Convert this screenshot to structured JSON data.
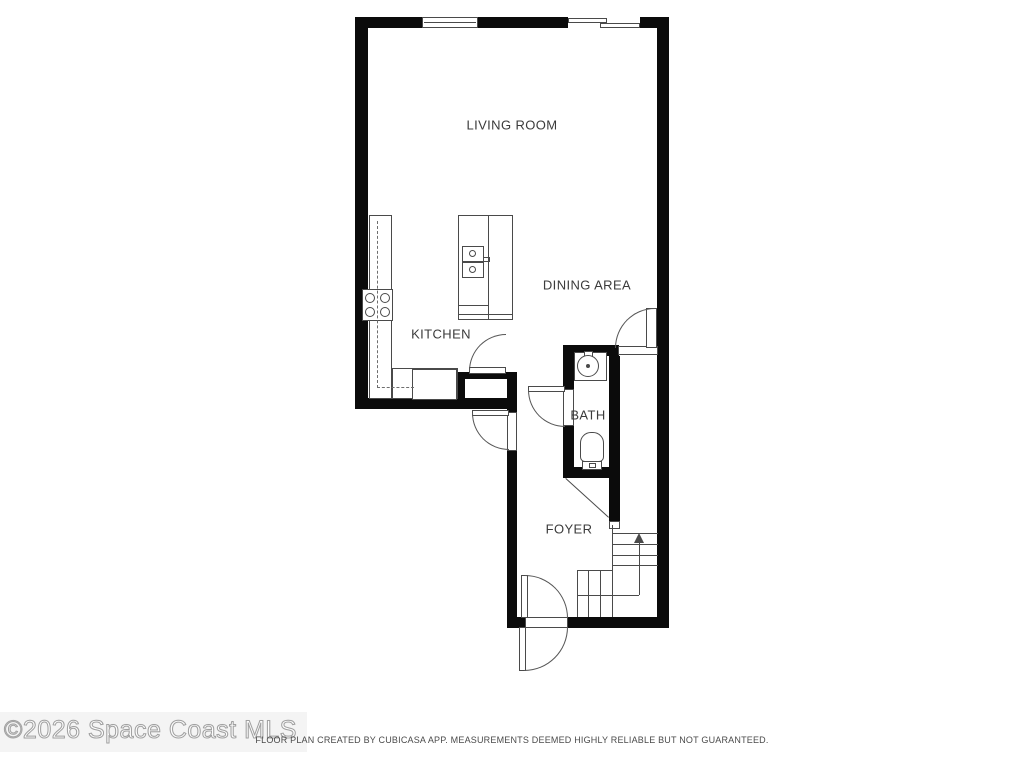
{
  "watermark": {
    "text": "©2026 Space Coast MLS"
  },
  "footer": {
    "text": "FLOOR PLAN CREATED BY CUBICASA APP. MEASUREMENTS DEEMED HIGHLY RELIABLE BUT NOT GUARANTEED."
  },
  "room_labels": [
    {
      "name": "living-room-label",
      "text": "LIVING ROOM",
      "x": 512,
      "y": 125
    },
    {
      "name": "dining-area-label",
      "text": "DINING AREA",
      "x": 587,
      "y": 285
    },
    {
      "name": "kitchen-label",
      "text": "KITCHEN",
      "x": 441,
      "y": 334
    },
    {
      "name": "bath-label",
      "text": "BATH",
      "x": 588,
      "y": 415
    },
    {
      "name": "foyer-label",
      "text": "FOYER",
      "x": 569,
      "y": 529
    }
  ],
  "colors": {
    "wall": "#0b0b0b",
    "line": "#4a4a4a",
    "label": "#3b3b3b",
    "bg": "#ffffff"
  },
  "geometry": {
    "walls": [
      {
        "n": "wall-top-left",
        "x": 355,
        "y": 17,
        "w": 67,
        "h": 11
      },
      {
        "n": "wall-top-mid",
        "x": 478,
        "y": 17,
        "w": 90,
        "h": 11
      },
      {
        "n": "wall-top-right",
        "x": 640,
        "y": 17,
        "w": 28,
        "h": 11
      },
      {
        "n": "wall-left",
        "x": 355,
        "y": 17,
        "w": 13,
        "h": 392
      },
      {
        "n": "wall-right",
        "x": 657,
        "y": 17,
        "w": 12,
        "h": 611
      },
      {
        "n": "wall-kitchen-bottom",
        "x": 355,
        "y": 398,
        "w": 162,
        "h": 11
      },
      {
        "n": "wall-closet-top",
        "x": 457,
        "y": 372,
        "w": 60,
        "h": 7
      },
      {
        "n": "wall-closet-left",
        "x": 457,
        "y": 372,
        "w": 8,
        "h": 37
      },
      {
        "n": "wall-foyer-west-upper",
        "x": 507,
        "y": 372,
        "w": 10,
        "h": 41
      },
      {
        "n": "wall-foyer-west-lower",
        "x": 507,
        "y": 450,
        "w": 10,
        "h": 178
      },
      {
        "n": "wall-bottom-left",
        "x": 507,
        "y": 617,
        "w": 19,
        "h": 11
      },
      {
        "n": "wall-bottom-right",
        "x": 567,
        "y": 617,
        "w": 102,
        "h": 11
      },
      {
        "n": "wall-dining-south",
        "x": 563,
        "y": 345,
        "w": 56,
        "h": 11
      },
      {
        "n": "wall-bath-west-upper",
        "x": 563,
        "y": 345,
        "w": 11,
        "h": 44
      },
      {
        "n": "wall-bath-west-lower",
        "x": 563,
        "y": 426,
        "w": 11,
        "h": 52
      },
      {
        "n": "wall-bath-east",
        "x": 609,
        "y": 356,
        "w": 11,
        "h": 166
      },
      {
        "n": "wall-bath-bottom",
        "x": 563,
        "y": 467,
        "w": 57,
        "h": 11
      }
    ],
    "openings": [
      {
        "n": "dining-door-threshold",
        "x": 618,
        "y": 346,
        "w": 40,
        "h": 9
      },
      {
        "n": "side-door-jamb",
        "x": 507,
        "y": 412,
        "w": 10,
        "h": 39
      },
      {
        "n": "entry-door-threshold",
        "x": 525,
        "y": 617,
        "w": 43,
        "h": 11
      },
      {
        "n": "bath-door-jamb",
        "x": 563,
        "y": 389,
        "w": 11,
        "h": 37
      },
      {
        "n": "stair-wall-end-cap",
        "x": 609,
        "y": 521,
        "w": 11,
        "h": 8
      }
    ],
    "fixtures": [
      {
        "n": "window",
        "x": 422,
        "y": 17,
        "w": 56,
        "h": 11
      },
      {
        "n": "slider-panel-1",
        "x": 568,
        "y": 18,
        "w": 39,
        "h": 5
      },
      {
        "n": "slider-panel-2",
        "x": 600,
        "y": 23,
        "w": 40,
        "h": 5
      },
      {
        "n": "counter-left",
        "x": 369,
        "y": 215,
        "w": 23,
        "h": 184
      },
      {
        "n": "counter-bottom",
        "x": 392,
        "y": 368,
        "w": 66,
        "h": 31
      },
      {
        "n": "dishwasher",
        "x": 412,
        "y": 369,
        "w": 45,
        "h": 31
      },
      {
        "n": "stove",
        "x": 362,
        "y": 289,
        "w": 31,
        "h": 32
      },
      {
        "n": "island",
        "x": 458,
        "y": 215,
        "w": 55,
        "h": 105
      },
      {
        "n": "island-sink-upper",
        "x": 462,
        "y": 246,
        "w": 22,
        "h": 16
      },
      {
        "n": "island-sink-lower",
        "x": 462,
        "y": 262,
        "w": 22,
        "h": 16
      },
      {
        "n": "island-faucet",
        "x": 483,
        "y": 257,
        "w": 7,
        "h": 5
      },
      {
        "n": "bath-vanity",
        "x": 574,
        "y": 352,
        "w": 33,
        "h": 29
      },
      {
        "n": "bath-faucet",
        "x": 584,
        "y": 351,
        "w": 9,
        "h": 7
      },
      {
        "n": "toilet-bowl",
        "x": 580,
        "y": 432,
        "w": 24,
        "h": 30,
        "r": "11px 11px 5px 5px"
      },
      {
        "n": "toilet-tank",
        "x": 582,
        "y": 461,
        "w": 20,
        "h": 9
      },
      {
        "n": "toilet-button",
        "x": 589,
        "y": 463,
        "w": 7,
        "h": 5
      },
      {
        "n": "pantry-door-leaf",
        "x": 469,
        "y": 367,
        "w": 37,
        "h": 7
      },
      {
        "n": "side-door-leaf",
        "x": 472,
        "y": 410,
        "w": 37,
        "h": 6
      },
      {
        "n": "bath-door-leaf",
        "x": 528,
        "y": 386,
        "w": 37,
        "h": 6
      },
      {
        "n": "dining-door-leaf",
        "x": 646,
        "y": 308,
        "w": 11,
        "h": 40
      },
      {
        "n": "entry-leaf-inner",
        "x": 521,
        "y": 575,
        "w": 7,
        "h": 43
      },
      {
        "n": "entry-leaf-outer",
        "x": 519,
        "y": 627,
        "w": 7,
        "h": 44
      }
    ],
    "lines": [
      {
        "n": "window-mullion",
        "x": 424,
        "y": 22,
        "w": 52,
        "h": 1
      },
      {
        "n": "island-divider",
        "x": 488,
        "y": 215,
        "w": 1,
        "h": 105
      },
      {
        "n": "island-shelf-1",
        "x": 458,
        "y": 305,
        "w": 30,
        "h": 1
      },
      {
        "n": "island-shelf-2",
        "x": 458,
        "y": 314,
        "w": 55,
        "h": 1
      },
      {
        "n": "stair-tread-1",
        "x": 612,
        "y": 533,
        "w": 46,
        "h": 1
      },
      {
        "n": "stair-tread-2",
        "x": 612,
        "y": 544,
        "w": 46,
        "h": 1
      },
      {
        "n": "stair-tread-3",
        "x": 612,
        "y": 555,
        "w": 46,
        "h": 1
      },
      {
        "n": "stair-tread-4",
        "x": 612,
        "y": 565,
        "w": 46,
        "h": 1
      },
      {
        "n": "stair-corner",
        "x": 577,
        "y": 570,
        "w": 36,
        "h": 1
      },
      {
        "n": "stair-tread-v1",
        "x": 577,
        "y": 570,
        "w": 1,
        "h": 47
      },
      {
        "n": "stair-tread-v2",
        "x": 588,
        "y": 570,
        "w": 1,
        "h": 47
      },
      {
        "n": "stair-tread-v3",
        "x": 600,
        "y": 570,
        "w": 1,
        "h": 47
      },
      {
        "n": "stair-open-edge",
        "x": 612,
        "y": 525,
        "w": 1,
        "h": 92
      },
      {
        "n": "stair-walkline-h",
        "x": 577,
        "y": 595,
        "w": 62,
        "h": 1
      },
      {
        "n": "stair-walkline-v",
        "x": 639,
        "y": 543,
        "w": 1,
        "h": 52
      }
    ],
    "dashed": [
      {
        "n": "upper-cabinet-v",
        "x": 377,
        "y": 221,
        "w": 0,
        "h": 167
      },
      {
        "n": "upper-cabinet-h",
        "x": 377,
        "y": 387,
        "w": 37,
        "h": 0
      }
    ],
    "circles": [
      {
        "n": "burner-1",
        "x": 365,
        "y": 293,
        "d": 10
      },
      {
        "n": "burner-2",
        "x": 380,
        "y": 293,
        "d": 10
      },
      {
        "n": "burner-3",
        "x": 365,
        "y": 307,
        "d": 10
      },
      {
        "n": "burner-4",
        "x": 380,
        "y": 307,
        "d": 10
      },
      {
        "n": "sink-drain-1",
        "x": 469,
        "y": 250,
        "d": 7
      },
      {
        "n": "sink-drain-2",
        "x": 469,
        "y": 266,
        "d": 7
      },
      {
        "n": "bath-sink",
        "x": 577,
        "y": 355,
        "d": 22
      },
      {
        "n": "bath-sink-drain",
        "x": 586,
        "y": 364,
        "d": 4,
        "fill": true
      }
    ],
    "arcs": [
      {
        "n": "pantry-door-swing",
        "x": 469,
        "y": 334,
        "s": 37,
        "q": "tl"
      },
      {
        "n": "side-door-swing",
        "x": 472,
        "y": 413,
        "s": 37,
        "q": "bl"
      },
      {
        "n": "bath-door-swing",
        "x": 528,
        "y": 390,
        "s": 37,
        "q": "bl"
      },
      {
        "n": "dining-door-swing",
        "x": 615,
        "y": 308,
        "s": 40,
        "q": "tl"
      },
      {
        "n": "entry-swing-inner",
        "x": 525,
        "y": 575,
        "s": 43,
        "q": "tr"
      },
      {
        "n": "entry-swing-outer",
        "x": 524,
        "y": 627,
        "s": 44,
        "q": "br"
      }
    ],
    "diagonals": [
      {
        "n": "understair-line",
        "x": 566,
        "y": 478,
        "len": 58,
        "ang": 42.2
      }
    ],
    "arrows": [
      {
        "n": "stair-up-arrow",
        "x": 634,
        "y": 533
      }
    ]
  }
}
